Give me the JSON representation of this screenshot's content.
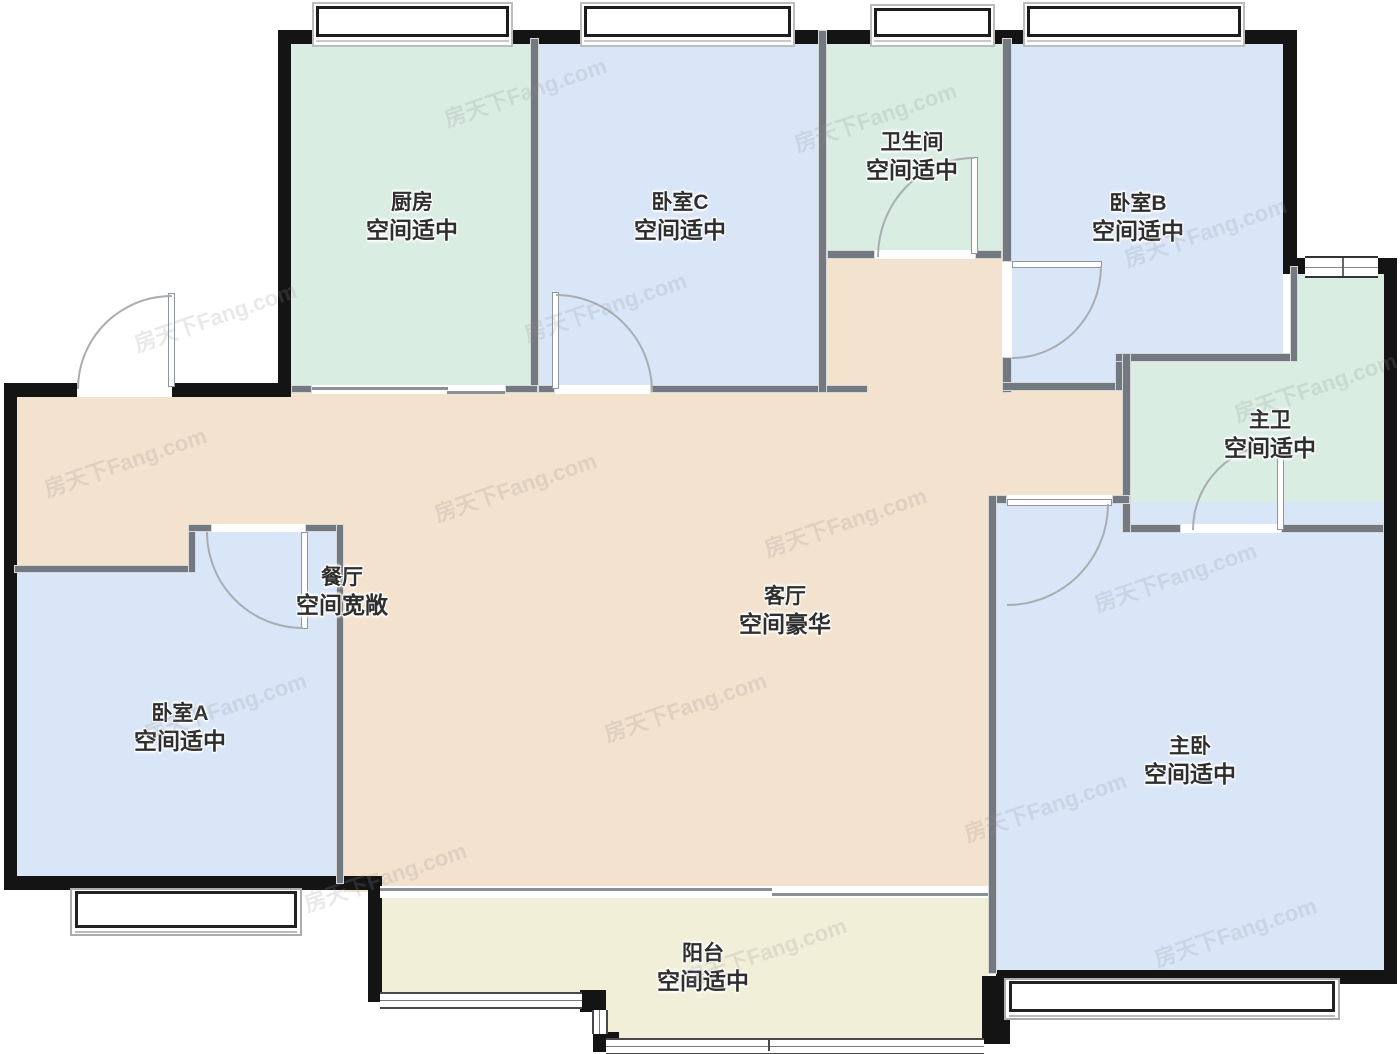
{
  "watermark": {
    "text": "房天下Fang.com"
  },
  "rooms": [
    {
      "id": "kitchen",
      "name": "厨房",
      "note": "空间适中"
    },
    {
      "id": "bedroom-c",
      "name": "卧室C",
      "note": "空间适中"
    },
    {
      "id": "bathroom",
      "name": "卫生间",
      "note": "空间适中"
    },
    {
      "id": "bedroom-b",
      "name": "卧室B",
      "note": "空间适中"
    },
    {
      "id": "master-bath",
      "name": "主卫",
      "note": "空间适中"
    },
    {
      "id": "dining",
      "name": "餐厅",
      "note": "空间宽敞"
    },
    {
      "id": "living",
      "name": "客厅",
      "note": "空间豪华"
    },
    {
      "id": "bedroom-a",
      "name": "卧室A",
      "note": "空间适中"
    },
    {
      "id": "master-bedroom",
      "name": "主卧",
      "note": "空间适中"
    },
    {
      "id": "balcony",
      "name": "阳台",
      "note": "空间适中"
    }
  ],
  "colors": {
    "bedroom": "#d9e6f8",
    "wet": "#d9ede3",
    "living": "#f3e2cd",
    "balcony": "#f1efd8",
    "wall_outer": "#141414",
    "wall_inner": "#737980"
  }
}
